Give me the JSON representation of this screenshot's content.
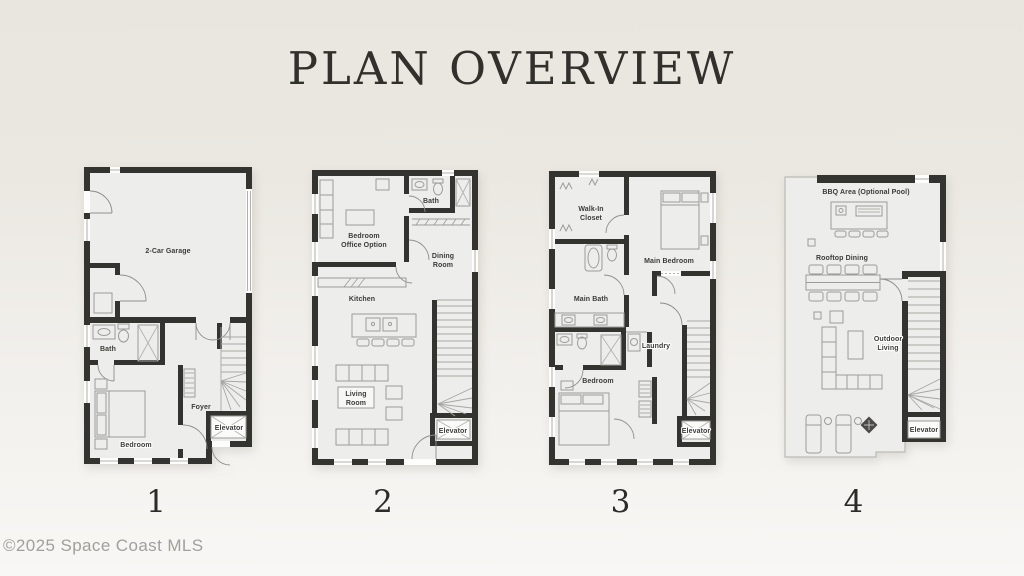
{
  "page": {
    "title": "PLAN OVERVIEW",
    "copyright": "©2025 Space Coast MLS"
  },
  "colors": {
    "background_top": "#e9e5df",
    "background_bottom": "#f8f7f5",
    "wall": "#33332f",
    "floor": "#ededeb",
    "room_label_text": "#3b3b38",
    "title_text": "#31302c",
    "copyright_text": "#a29f9a"
  },
  "floors": [
    {
      "number": "1",
      "rooms": {
        "garage": "2-Car Garage",
        "bath": "Bath",
        "bedroom": "Bedroom",
        "foyer": "Foyer",
        "elevator": "Elevator"
      }
    },
    {
      "number": "2",
      "rooms": {
        "bedroom_office_line1": "Bedroom",
        "bedroom_office_line2": "Office Option",
        "bath": "Bath",
        "dining_line1": "Dining",
        "dining_line2": "Room",
        "kitchen": "Kitchen",
        "living_line1": "Living",
        "living_line2": "Room",
        "elevator": "Elevator"
      }
    },
    {
      "number": "3",
      "rooms": {
        "walk_in_line1": "Walk-In",
        "walk_in_line2": "Closet",
        "main_bedroom": "Main Bedroom",
        "main_bath": "Main Bath",
        "laundry": "Laundry",
        "bedroom": "Bedroom",
        "elevator": "Elevator"
      }
    },
    {
      "number": "4",
      "rooms": {
        "bbq": "BBQ Area (Optional Pool)",
        "rooftop_dining": "Rooftop Dining",
        "outdoor_line1": "Outdoor",
        "outdoor_line2": "Living",
        "elevator": "Elevator"
      }
    }
  ]
}
